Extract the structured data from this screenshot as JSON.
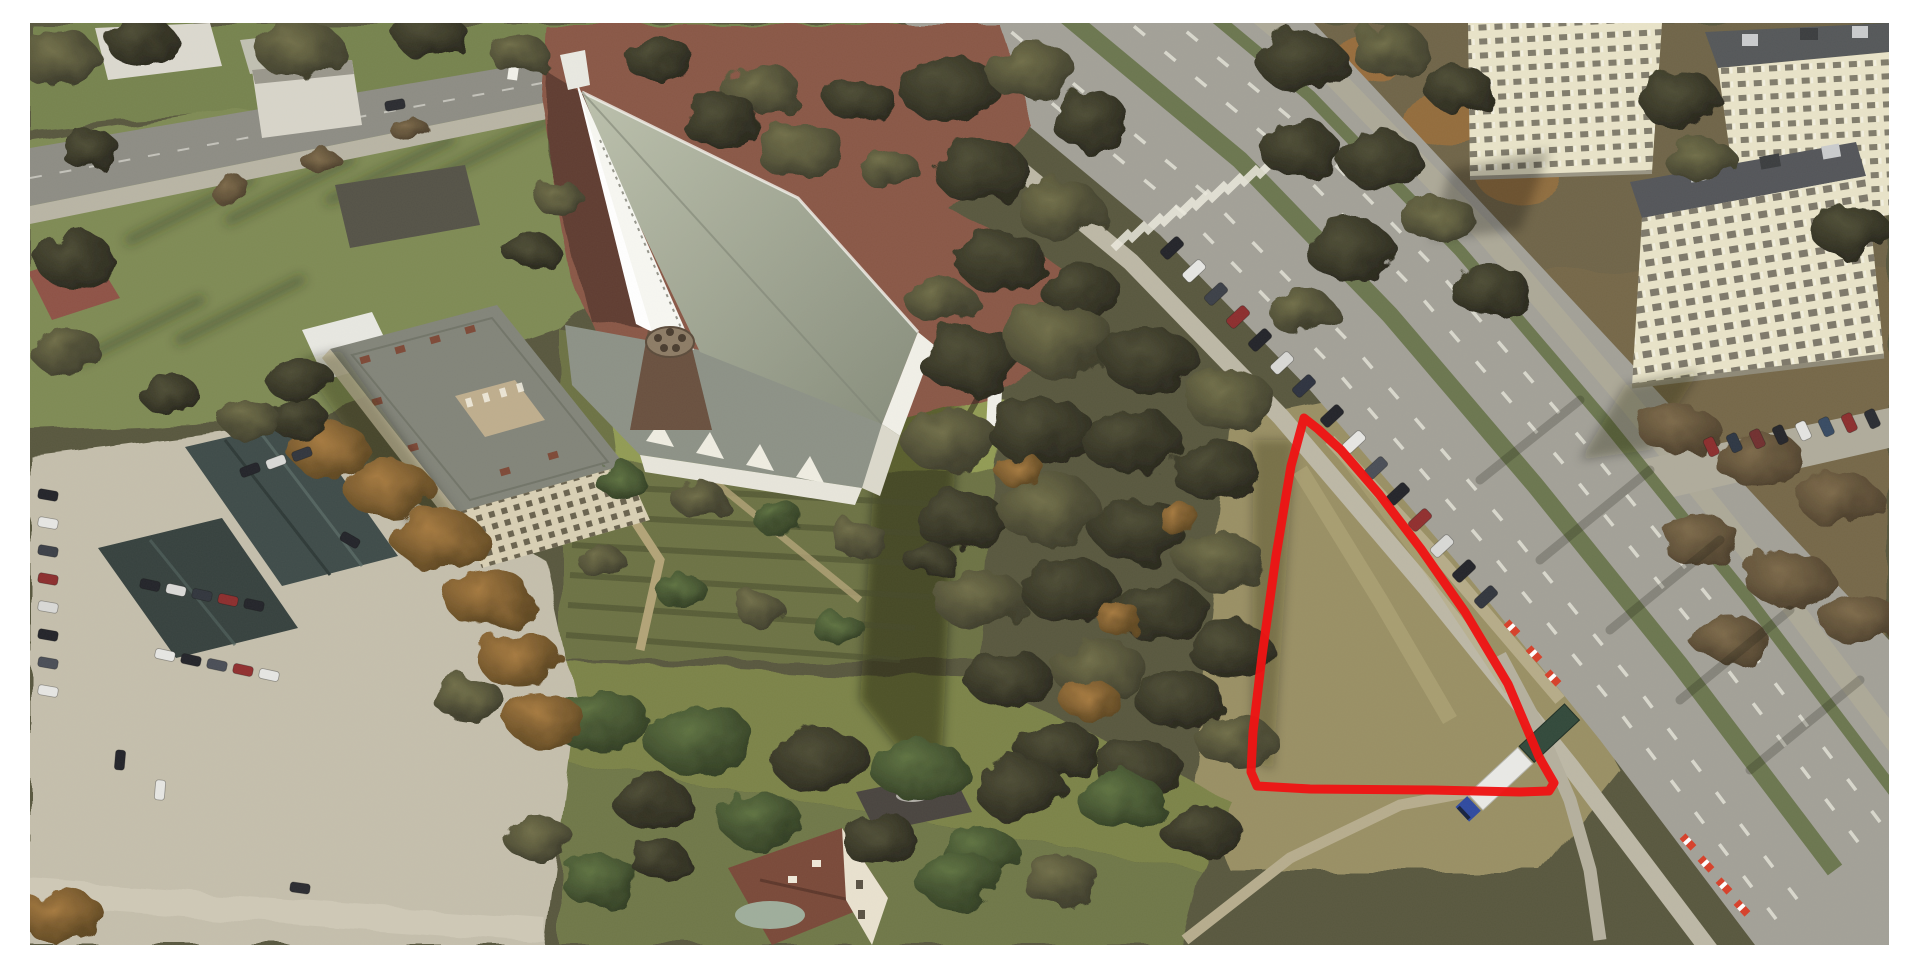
{
  "view": {
    "kind": "aerial-3d-photogrammetry",
    "description": "Oblique 3D aerial view of a church complex with monastery, gardens, a wide boulevard with parked cars, apartment towers and a red-outlined empty grass parcel",
    "season": "autumn"
  },
  "frame": {
    "color": "#ffffff"
  },
  "annotation": {
    "shape": "polygon",
    "label": "highlighted-parcel",
    "stroke_color": "#ee1414",
    "stroke_width": 9,
    "points": "1304,418 1291,466 1276,556 1262,656 1253,732 1251,772 1257,786 1310,789 1432,790 1520,792 1549,791 1554,783 1539,757 1508,684 1465,612 1421,549 1379,494 1341,450 1318,429"
  },
  "palette": {
    "ground_base": "#59583f",
    "grass_light": "#7f8b54",
    "dry_grass": "#9a9065",
    "concrete": "#c5bfad",
    "asphalt": "#a3a198",
    "asphalt_dark": "#8e8d85",
    "plaza_brick": "#8a5847",
    "church_white": "#f1f0e8",
    "church_roof": "#9aa08e",
    "monastery_facade": "#d9d0b5",
    "tower_facade": "#e9e4c9",
    "median_green": "#6c7750",
    "tree_dark": "#333226",
    "tree_autumn": "#9c6f3d"
  },
  "scene": {
    "landmarks": [
      "church-with-white-spire",
      "conical-brick-tower",
      "monastery-courtyard-building",
      "brick-plaza",
      "terraced-gardens",
      "dense-tree-belt",
      "highlighted-grass-parcel",
      "wide-boulevard",
      "green-median",
      "zebra-crosswalk",
      "parked-car-row",
      "construction-barriers",
      "semi-truck",
      "apartment-tower-1",
      "apartment-tower-2",
      "apartment-tower-3",
      "parking-lot",
      "barracks-building",
      "small-house",
      "white-monument"
    ],
    "vehicle_colors": [
      "#23242a",
      "#e6e6e3",
      "#8c2e2e",
      "#3c4048",
      "#d9d9d6"
    ]
  }
}
